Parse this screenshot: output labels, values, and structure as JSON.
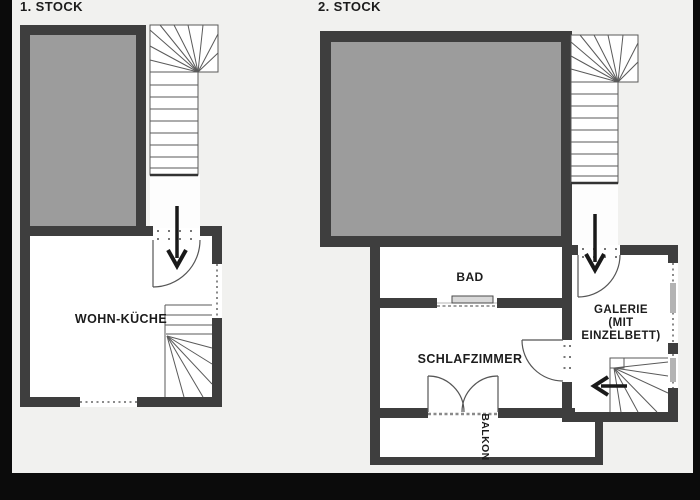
{
  "page": {
    "background_color": "#f1f1ef",
    "frame_color": "#0b0b0b",
    "wall_color": "#3e3e3e",
    "void_room_fill_color": "#9c9c9c",
    "text_color": "#1c1c1c"
  },
  "plan1": {
    "title": "1. STOCK",
    "room_wohn_kueche": "WOHN-KÜCHE"
  },
  "plan2": {
    "title": "2. STOCK",
    "room_bad": "BAD",
    "room_schlafzimmer": "SCHLAFZIMMER",
    "galerie_line1": "GALERIE",
    "galerie_line2": "(MIT",
    "galerie_line3": "EINZELBETT)",
    "room_balkon": "BALKON"
  },
  "icons": {
    "entry_arrow_floor1": "↓",
    "entry_arrow_floor2": "↓",
    "gallery_direction_arrow": "←"
  }
}
